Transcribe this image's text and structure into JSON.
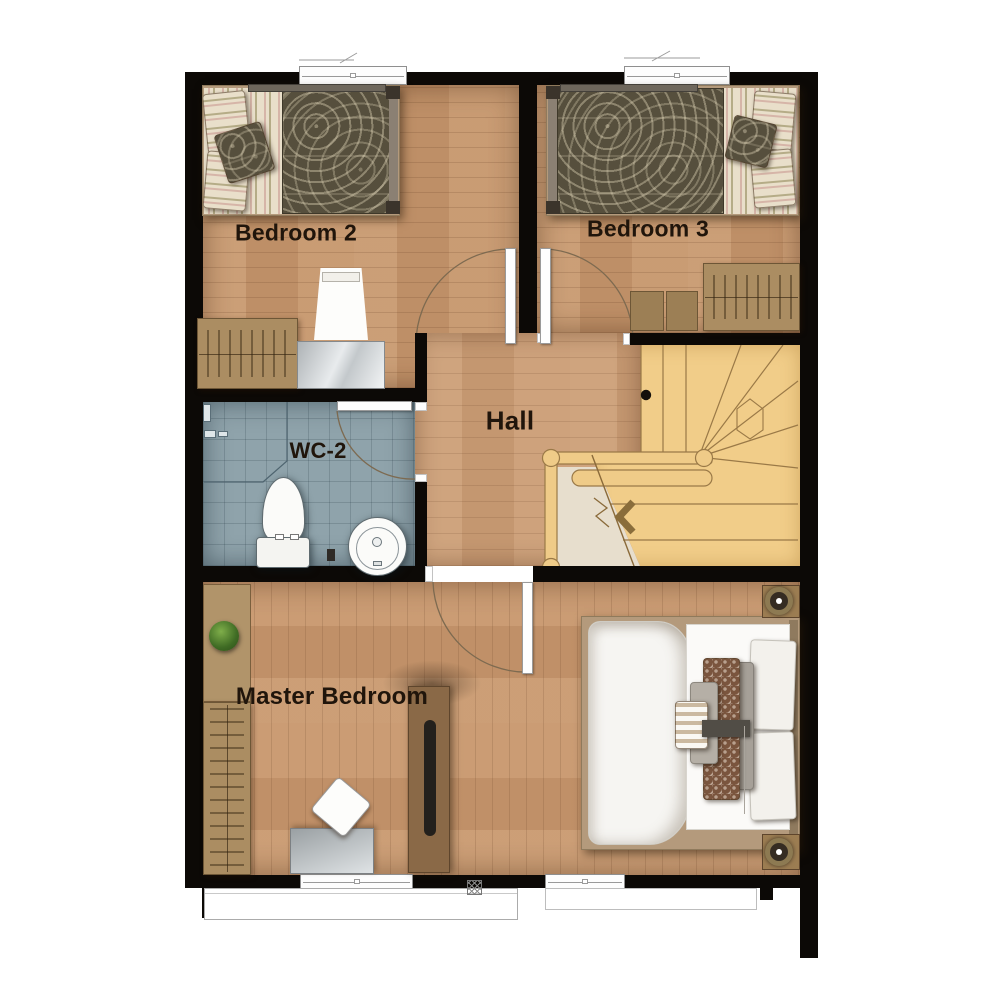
{
  "plan": {
    "title": "Second floor plan",
    "rooms": {
      "bedroom2": "Bedroom 2",
      "bedroom3": "Bedroom 3",
      "hall": "Hall",
      "wc2": "WC-2",
      "master_bedroom": "Master Bedroom"
    },
    "palette": {
      "wall": "#0c0906",
      "wood_floor": "#c6976e",
      "hall_floor": "#cb9e77",
      "master_floor": "#c8986f",
      "stair_wood": "#f1cd89",
      "stair_linework": "#9a7947",
      "landing": "#e7decd",
      "wc_floor": "#8fa3ab",
      "wardrobe": "#ab8d62",
      "bed_duvet_dark": "#564f3d",
      "master_duvet_white": "#f6f5f2",
      "label_text": "#20150b"
    }
  }
}
